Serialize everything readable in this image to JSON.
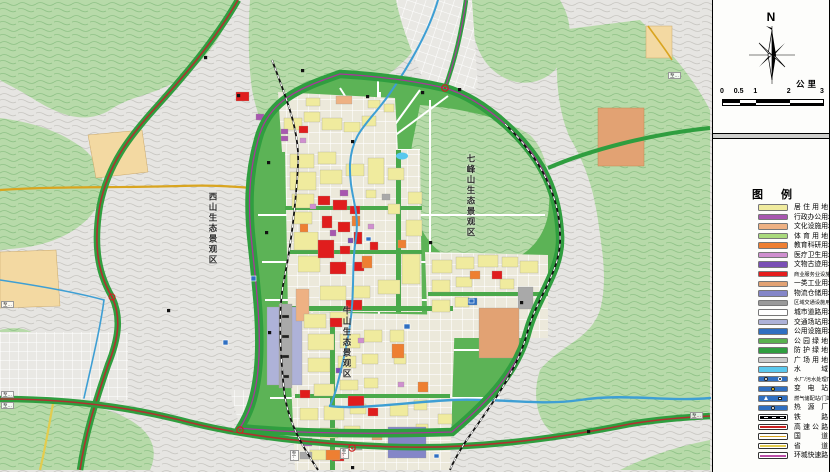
{
  "panel": {
    "north_label": "N",
    "scale": {
      "unit": "公里",
      "ticks": [
        "0",
        "0.5",
        "1",
        "2",
        "3"
      ],
      "km_values": [
        0,
        0.5,
        1,
        2,
        3
      ],
      "total_km": 3
    },
    "legend": {
      "title": "图例",
      "items": [
        {
          "label": "居住用地",
          "kind": "fill",
          "color": "#f0eb9e"
        },
        {
          "label": "行政办公用地",
          "kind": "fill",
          "color": "#a857b0"
        },
        {
          "label": "文化设施用地",
          "kind": "fill",
          "color": "#eeb183"
        },
        {
          "label": "体育用地",
          "kind": "fill",
          "color": "#a9d97c"
        },
        {
          "label": "教育科研用地",
          "kind": "fill",
          "color": "#ee7f32"
        },
        {
          "label": "医疗卫生用地",
          "kind": "fill",
          "color": "#cf8fcf"
        },
        {
          "label": "文物古迹用地",
          "kind": "fill",
          "color": "#7a4fb5"
        },
        {
          "label": "商业服务业设施用地",
          "kind": "fill",
          "color": "#e51c1c"
        },
        {
          "label": "一类工业用地",
          "kind": "fill",
          "color": "#e2a273"
        },
        {
          "label": "物流仓储用地",
          "kind": "fill",
          "color": "#8486c8"
        },
        {
          "label": "区域交通设施用地",
          "kind": "fill",
          "color": "#9a9a9a"
        },
        {
          "label": "城市道路用地",
          "kind": "fill",
          "color": "#ffffff"
        },
        {
          "label": "交通场站用地",
          "kind": "fill",
          "color": "#aeb2d8"
        },
        {
          "label": "公用设施用地",
          "kind": "fill",
          "color": "#2f6fc1"
        },
        {
          "label": "公园绿地",
          "kind": "fill",
          "color": "#59b24f"
        },
        {
          "label": "防护绿地",
          "kind": "fill",
          "color": "#2f9e3f"
        },
        {
          "label": "广场用地",
          "kind": "fill",
          "color": "#cccccc"
        },
        {
          "label": "水域",
          "kind": "fill",
          "color": "#59c8ee"
        },
        {
          "label": "水厂/污水处理厂",
          "kind": "utility",
          "color": "#2f6fc1",
          "icons": [
            "circle-white",
            "circle-dark"
          ]
        },
        {
          "label": "变电站",
          "kind": "utility",
          "color": "#2f6fc1",
          "icons": [
            "circle-yellow"
          ]
        },
        {
          "label": "燃气储配站/门站",
          "kind": "utility",
          "color": "#2f6fc1",
          "icons": [
            "triangle-white",
            "square-white"
          ]
        },
        {
          "label": "热源厂",
          "kind": "utility",
          "color": "#2f6fc1",
          "icons": [
            "circle-white"
          ]
        },
        {
          "label": "铁路",
          "kind": "line",
          "style": "railway",
          "color": "#000000"
        },
        {
          "label": "高速公路",
          "kind": "line",
          "color": "#cc2222"
        },
        {
          "label": "国道",
          "kind": "line",
          "color": "#d9a520"
        },
        {
          "label": "省道",
          "kind": "line",
          "color": "#e3cc4e"
        },
        {
          "label": "环城快速路",
          "kind": "line",
          "color": "#bb4fa8"
        }
      ]
    }
  },
  "map": {
    "region_labels": [
      {
        "id": "xishan",
        "text": "西山生态景观区"
      },
      {
        "id": "qifengshan",
        "text": "七峰山生态景观区"
      },
      {
        "id": "niushan",
        "text": "牛山生态景观区"
      }
    ],
    "edge_label_text": "至…",
    "colors": {
      "mountain_green": "#b7daa9",
      "hill_gray": "#e4e3e0",
      "park_green": "#5cb356",
      "expressway_red": "#b03030",
      "ring_magenta": "#a8389a",
      "river_blue": "#3e9fd4",
      "farmland_tan": "#f3d9a2"
    }
  }
}
